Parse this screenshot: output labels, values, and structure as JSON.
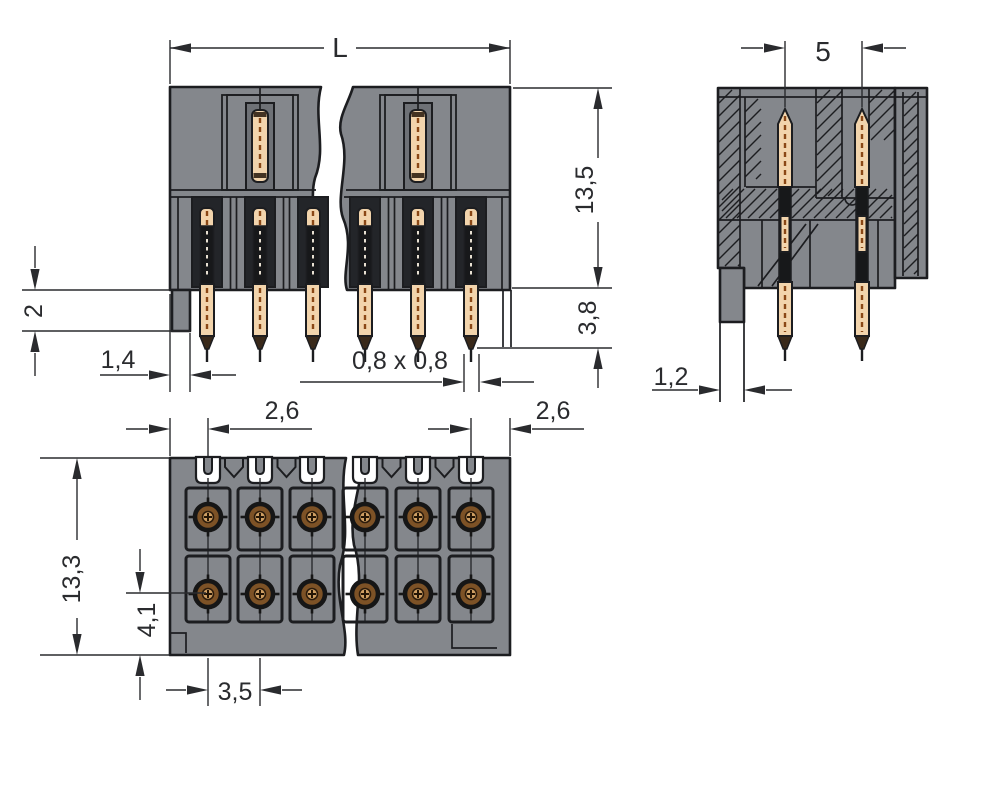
{
  "drawing": {
    "labels": {
      "total_length": "L",
      "total_height": "13,5",
      "pin_protrusion": "3,8",
      "standoff": "2",
      "edge_offset": "1,4",
      "pin_cross_section": "0,8 x 0,8",
      "row_spacing": "5",
      "peg_width": "1,2",
      "edge_to_pin_left": "2,6",
      "edge_to_pin_right": "2,6",
      "body_depth": "13,3",
      "row_offset": "4,1",
      "pin_pitch": "3,5"
    },
    "colors": {
      "bg": "#ffffff",
      "body": "#84878c",
      "slot": "#232529",
      "line": "#1c1d20",
      "pin": "#f2d4ac",
      "pinDash": "#8a4715",
      "tip": "#39291a",
      "bronze": "#7d5226",
      "holeC": "#cf9f63",
      "dim": "#2a2b2e"
    }
  }
}
